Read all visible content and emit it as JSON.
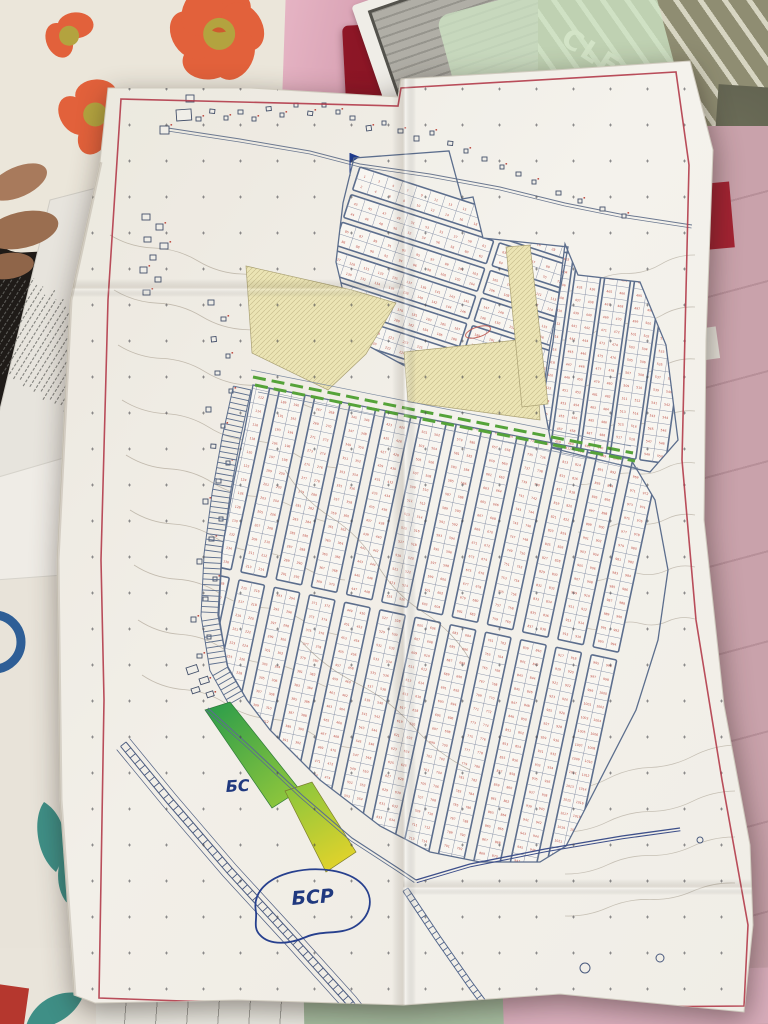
{
  "photo": {
    "bag_text": "CLEAR BAG",
    "map": {
      "labels": {
        "canal_label_upper": "БС",
        "canal_label_lower": "БСР"
      },
      "parcel_numbers": {
        "range_start": 1,
        "range_end": 960,
        "visible_samples": [
          "110",
          "113",
          "115",
          "190",
          "277",
          "334",
          "403",
          "411",
          "427",
          "457",
          "504",
          "534",
          "536",
          "640",
          "749",
          "753",
          "777",
          "808",
          "856",
          "903",
          "914"
        ]
      },
      "grids": {
        "upper": {
          "strips": 8,
          "cells_per_strip": [
            10,
            11
          ],
          "rows_per_strip": 2,
          "start_number": 1
        },
        "right": {
          "strips": 5,
          "cells_per_strip": [
            15
          ],
          "rows_per_strip": 2,
          "start_number": 401
        },
        "lower": {
          "strips": 12,
          "cells_per_strip": [
            18,
            21
          ],
          "rows_per_strip": 2,
          "start_number": 101
        }
      }
    },
    "colors": {
      "paper": "#f2efe9",
      "map_border": "#b23b4a",
      "street": "#5c6e8d",
      "street_light": "#8892a8",
      "parcel_fill": "#f8f6f1",
      "parcel_number": "#c0544a",
      "reserved_yellow": "#ebe4b4",
      "hatch": "#b9ae7e",
      "green_road": "#55a339",
      "water_blue": "#27408e",
      "canal_green": "#2f9e4a",
      "canal_mid": "#8ec63c",
      "canal_yellow": "#ddd22c",
      "contour": "#9c9181",
      "label_blue": "#20397f",
      "dots": "#45454a",
      "folder_red": "#8e1626",
      "bag_khaki": "#8f8d72",
      "bag_stripe": "#e2e0cd",
      "mesh_green": "#cfe6c6",
      "quilt_pink": "#c9a2ab",
      "pink_top": "#e2aebd",
      "pillow_cream": "#ece7db",
      "flower_orange": "#e2613b",
      "flower_center": "#b3a33f",
      "stem_blue": "#2e5e96",
      "sheet_white": "#e9e4da",
      "leaf_teal": "#3f8f86",
      "green_paper": "#a6bda0",
      "pink_bottom": "#dab0bd",
      "red_sliver": "#b5372e",
      "skin": "#a87a5c",
      "shadow_bg": "#1f1b18"
    }
  }
}
